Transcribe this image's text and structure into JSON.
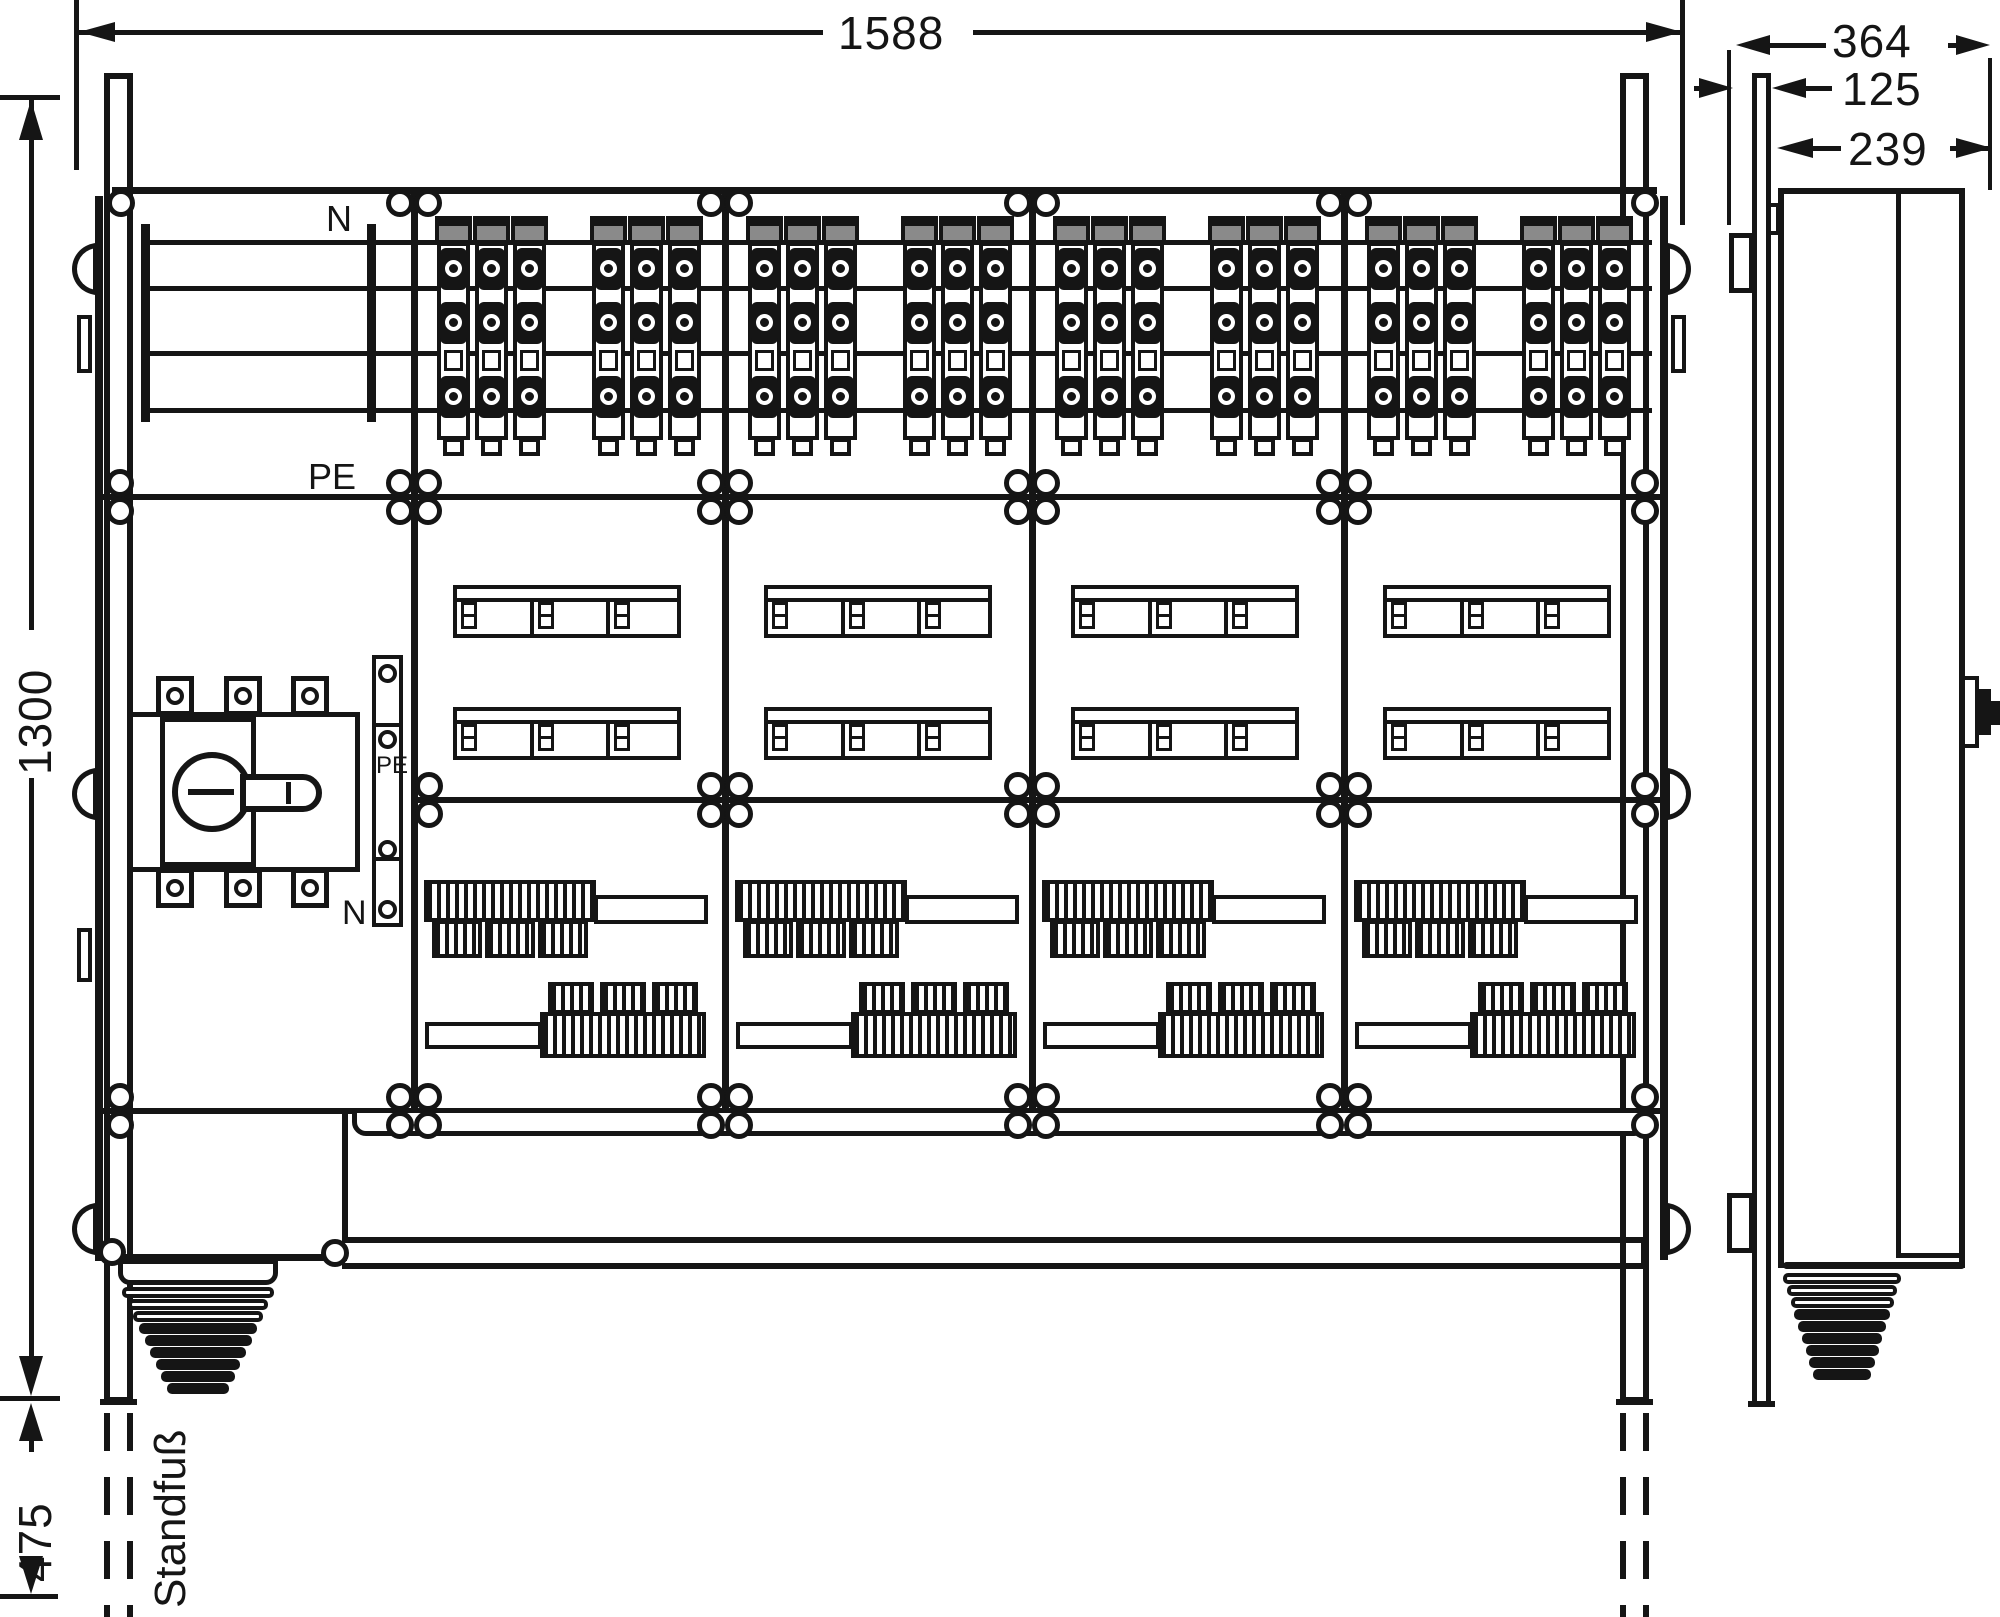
{
  "dimensions": {
    "width_mm": "1588",
    "height_mm": "1300",
    "foot_mm": "475",
    "depth_total_mm": "364",
    "depth_wall_mm": "125",
    "depth_body_mm": "239"
  },
  "labels": {
    "busbar_n": "N",
    "busbar_pe": "PE",
    "pe_terminal": "PE",
    "n_terminal": "N",
    "stand_foot": "Standfuß"
  }
}
